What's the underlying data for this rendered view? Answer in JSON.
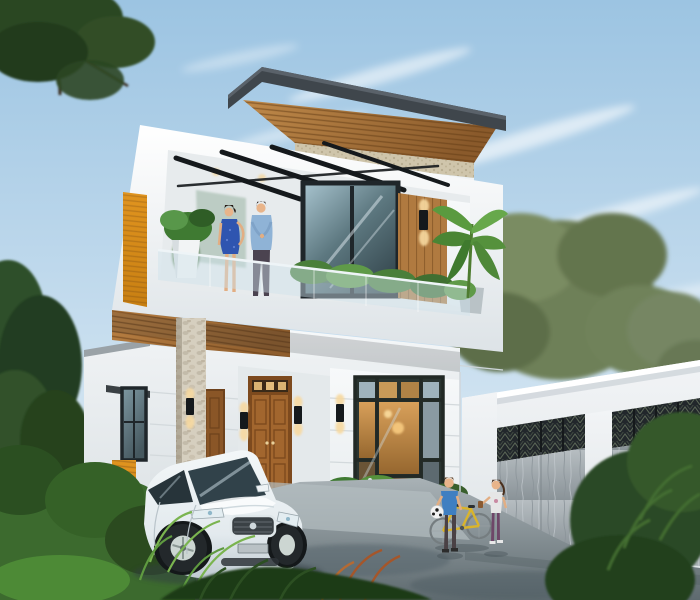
{
  "scene": {
    "title": "Modern two-storey house exterior 3D render",
    "elements": [
      {
        "name": "house",
        "description": "white modern two-storey villa with flat overhanging roof, wood-slat soffits, stone pillar and orange accent panels"
      },
      {
        "name": "balcony",
        "description": "second-floor balcony with glass railing, black pergola beams, potted plants and a banana plant"
      },
      {
        "name": "balcony-couple",
        "description": "woman in blue dress and man in light blue shirt standing on the balcony"
      },
      {
        "name": "main-door",
        "description": "wooden double entry door with transom glass and wall sconces"
      },
      {
        "name": "ground-window",
        "description": "large black-framed window with warm interior light over a stone flower bed"
      },
      {
        "name": "car",
        "description": "white sedan parked in the driveway"
      },
      {
        "name": "boy",
        "description": "boy in blue t-shirt holding a soccer ball"
      },
      {
        "name": "girl",
        "description": "girl in white top walking near a yellow bicycle"
      },
      {
        "name": "bicycle",
        "description": "yellow kids bicycle"
      },
      {
        "name": "fence",
        "description": "white boundary wall with two grey stone gate panels topped by dark decorative lattice"
      },
      {
        "name": "vegetation",
        "description": "lush garden, ferns, background trees and foreground shrubs"
      },
      {
        "name": "sky",
        "description": "light blue sky with wispy clouds"
      }
    ]
  },
  "colors": {
    "sky-top": "#9cc4e2",
    "sky-mid": "#c6ddee",
    "sky-low": "#e6f0f7",
    "wall-white": "#f7f9fa",
    "wall-shade": "#e3e8ea",
    "roof-dark": "#3f464c",
    "wood-light": "#c08a4a",
    "wood-dark": "#8a5a2b",
    "wood-door": "#a2662e",
    "accent-orange": "#e0941f",
    "frame-black": "#1f262a",
    "stone-light": "#d6cfbf",
    "glow-warm": "#f7d9a0",
    "fence-white": "#f2f4f6",
    "gate-panel": "#a9b1b6",
    "lattice-dark": "#22272b",
    "drive-light": "#a9b2b6",
    "drive-dark": "#5e6a6f",
    "car-white": "#f3f7f8",
    "car-glass": "#31424a",
    "foliage-dark": "#2b4723",
    "foliage-mid": "#47663a",
    "foliage-olive": "#6e8058",
    "boy-shirt": "#3f7fc1",
    "woman-dress": "#2f55b0",
    "man-shirt": "#8fb3d6",
    "bike-yellow": "#d9b42c",
    "skin": "#e8b48a"
  }
}
